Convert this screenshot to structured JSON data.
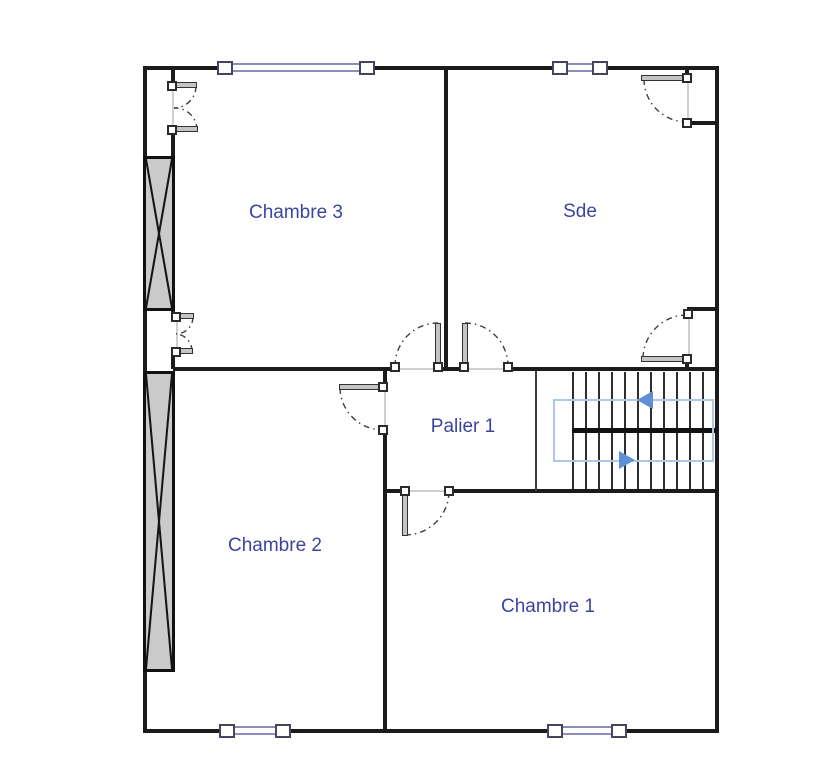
{
  "plan": {
    "rooms": {
      "chambre3": "Chambre 3",
      "sde": "Sde",
      "palier1": "Palier 1",
      "chambre2": "Chambre 2",
      "chambre1": "Chambre 1"
    },
    "stairs": {
      "tread_count": 11,
      "flights": 2,
      "up_flight_arrow": "left",
      "down_flight_arrow": "right"
    },
    "colors": {
      "wall": "#1b1b1b",
      "room_label": "#3b459f",
      "window_frame": "#8d8dbd",
      "window_cap_border": "#45455e",
      "hatch_fill": "#cacaca",
      "door_arc": "#3f3f3f",
      "door_leaf": "#c4c4c4",
      "jamb_border": "#2b2b2b",
      "thin_line": "#cfcfcf",
      "tread": "#2e2e2e",
      "stair_route": "#abc8e8",
      "stair_arrow": "#5b8fd6"
    }
  }
}
